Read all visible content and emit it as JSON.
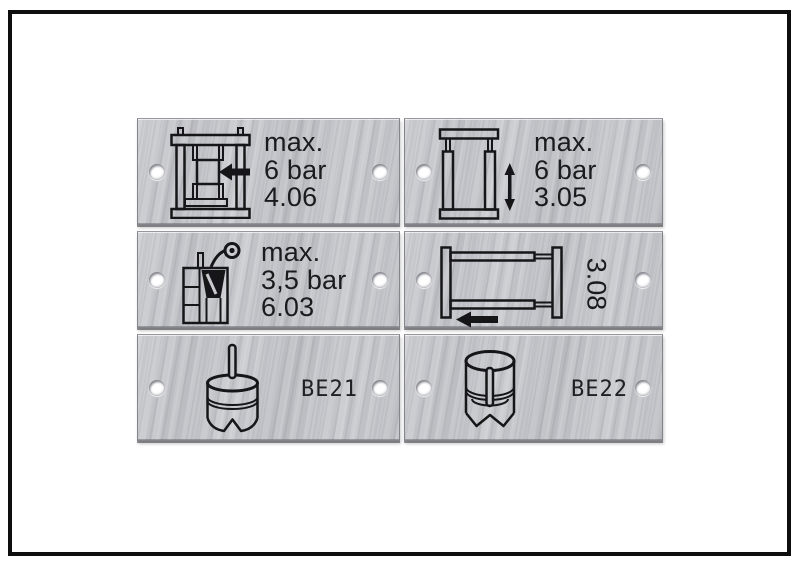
{
  "colors": {
    "background": "#ffffff",
    "frame": "#0e0e0e",
    "plate_metal": "#c6c7cb",
    "ink": "#1b1b1d",
    "hole": "#ffffff"
  },
  "plates": [
    {
      "id": "plate-4-06",
      "icon": "press-clamp-horizontal-arrow-icon",
      "line1": "max.",
      "line2": "6 bar",
      "line3": "4.06"
    },
    {
      "id": "plate-3-05",
      "icon": "vertical-clamp-double-arrow-icon",
      "line1": "max.",
      "line2": "6 bar",
      "line3": "3.05"
    },
    {
      "id": "plate-6-03",
      "icon": "glue-applicator-nozzle-icon",
      "line1": "max.",
      "line2": "3,5 bar",
      "line3": "6.03"
    },
    {
      "id": "plate-3-08",
      "icon": "horizontal-slide-left-arrow-icon",
      "code": "3.08"
    },
    {
      "id": "plate-BE21",
      "icon": "bellows-suction-pin-icon",
      "code": "BE21"
    },
    {
      "id": "plate-BE22",
      "icon": "open-cup-pin-icon",
      "code": "BE22"
    }
  ]
}
